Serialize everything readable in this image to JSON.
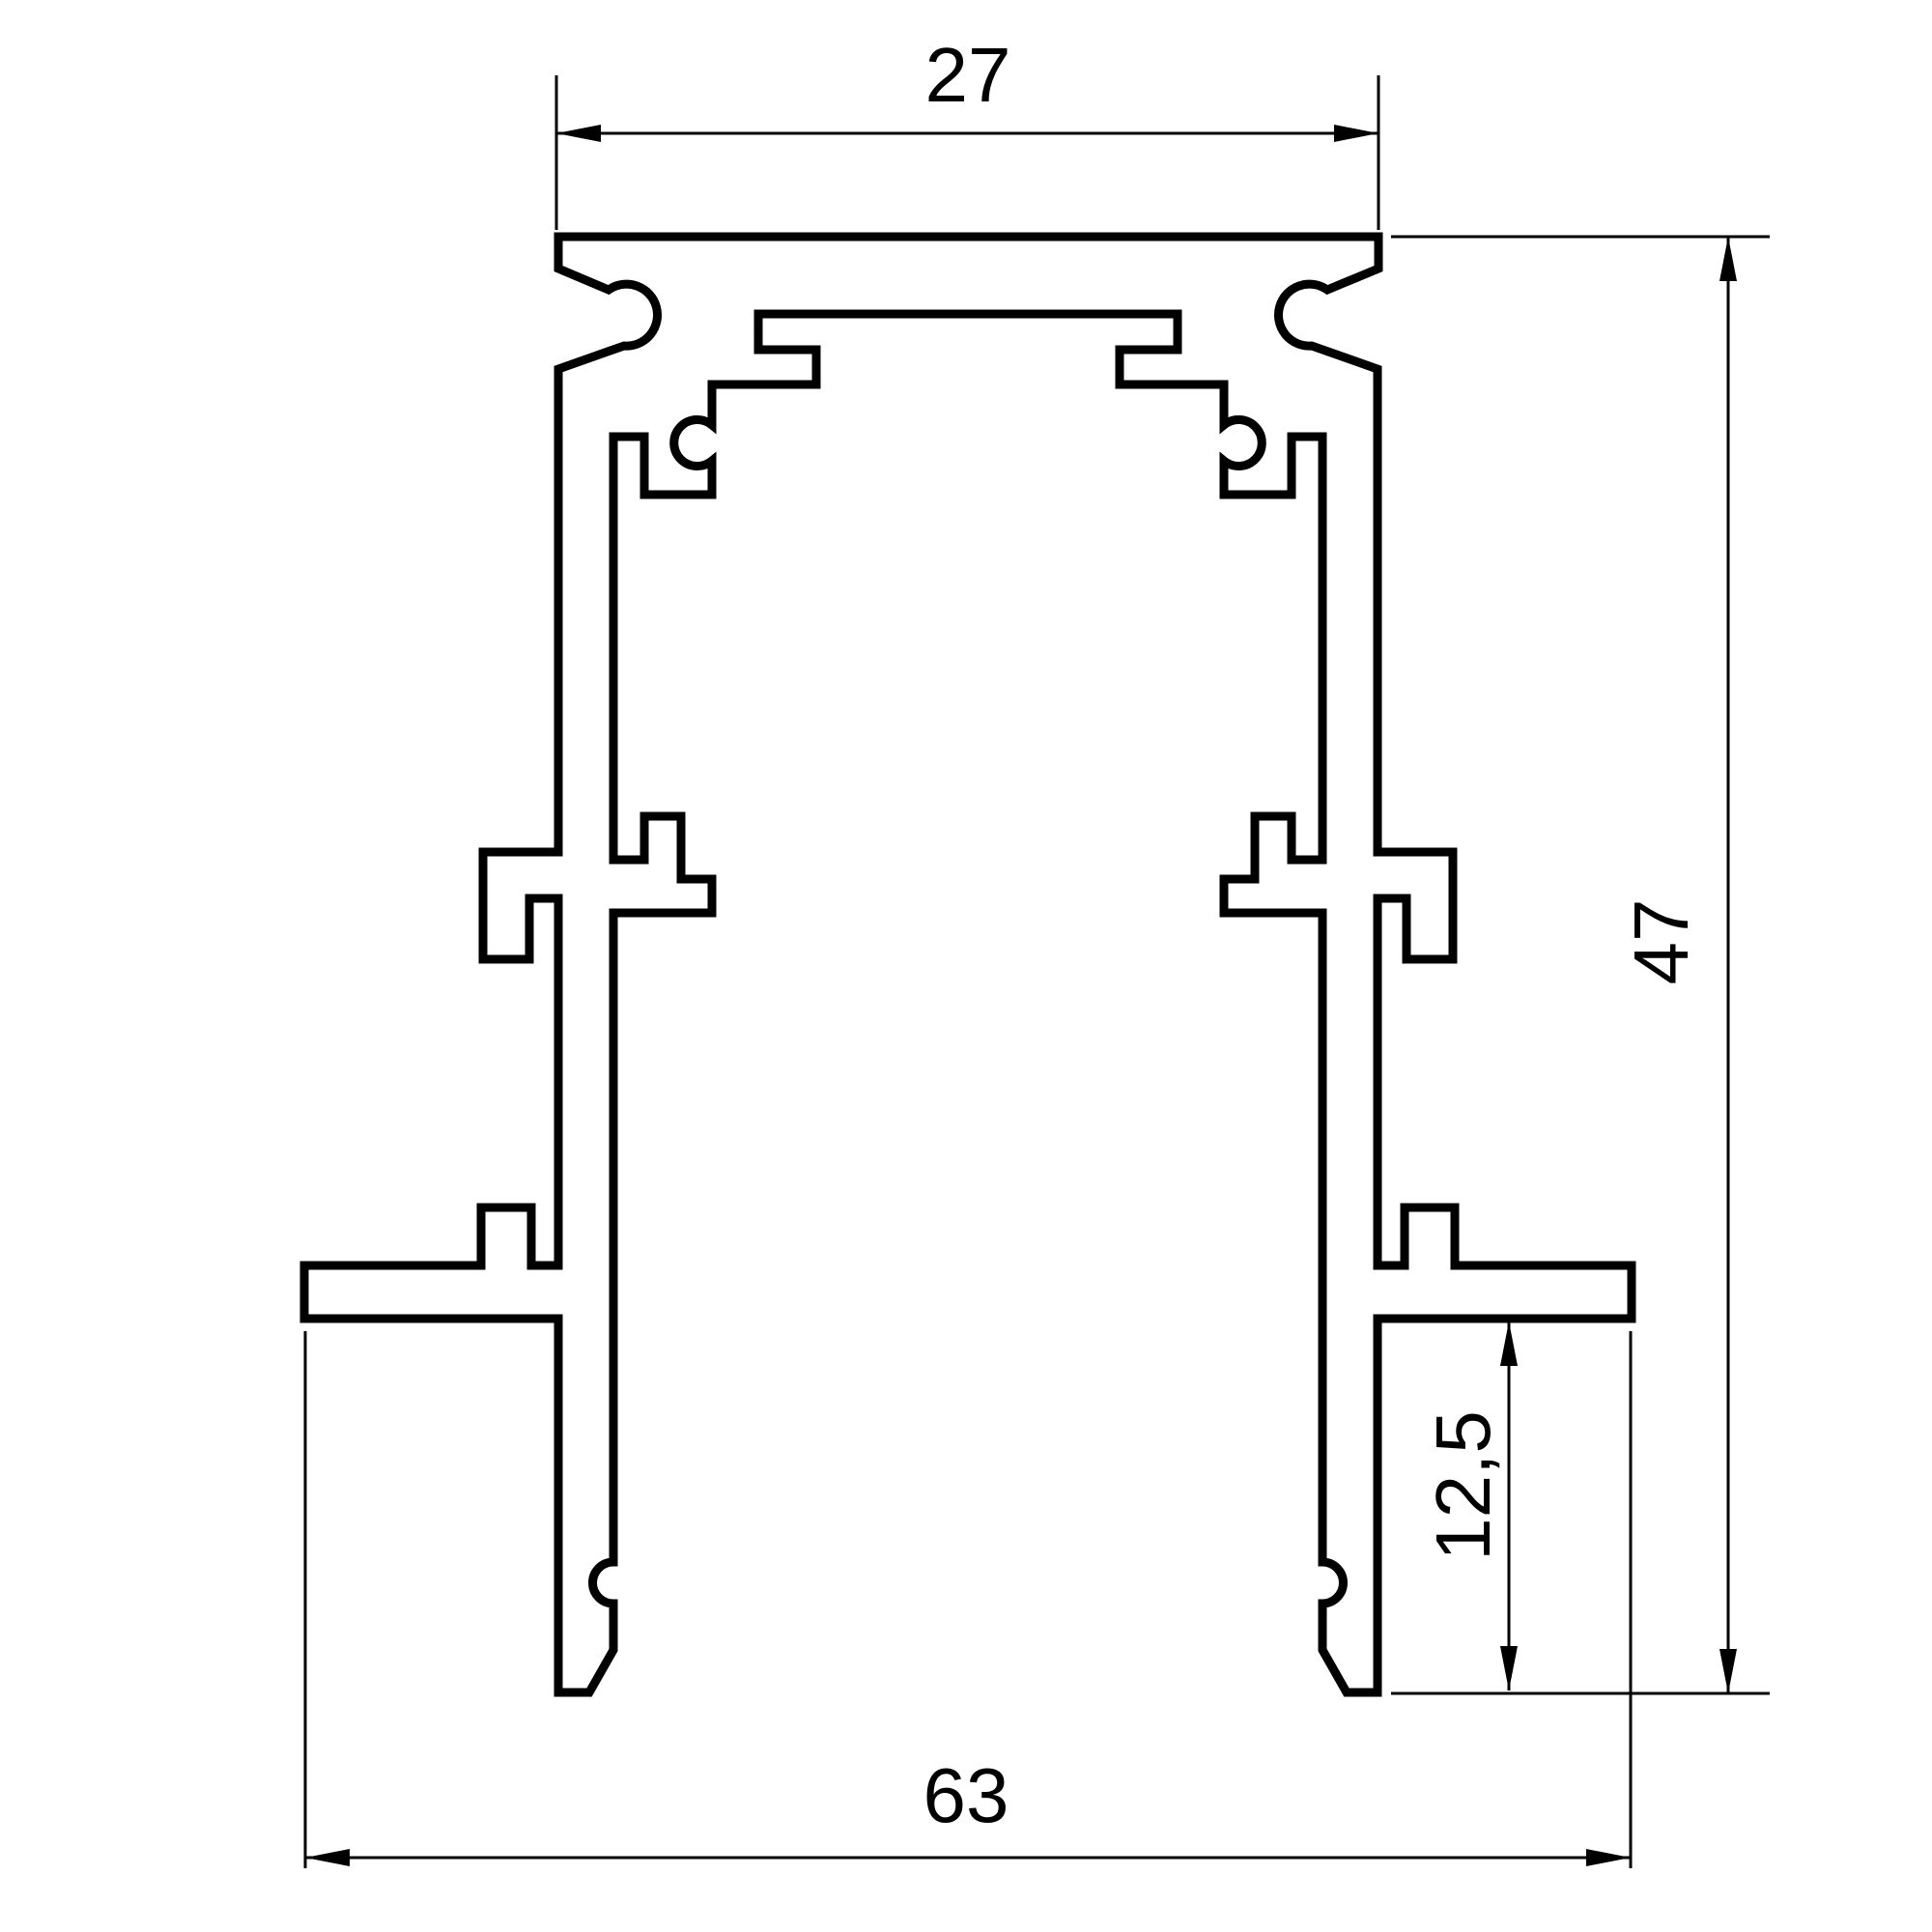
{
  "page": {
    "background": "#ffffff",
    "stroke_color": "#000000",
    "description": "Technical cross-section drawing of a recessed magnetic track profile with dimension callouts"
  },
  "drawing": {
    "dimensions": {
      "top_width": {
        "label": "27",
        "value": 27,
        "orientation": "horizontal",
        "position": "top"
      },
      "overall_height": {
        "label": "47",
        "value": 47,
        "orientation": "vertical",
        "position": "right"
      },
      "inner_height": {
        "label": "12,5",
        "value": 12.5,
        "orientation": "vertical",
        "position": "bottom-right-inner"
      },
      "overall_width": {
        "label": "63",
        "value": 63,
        "orientation": "horizontal",
        "position": "bottom"
      }
    }
  }
}
